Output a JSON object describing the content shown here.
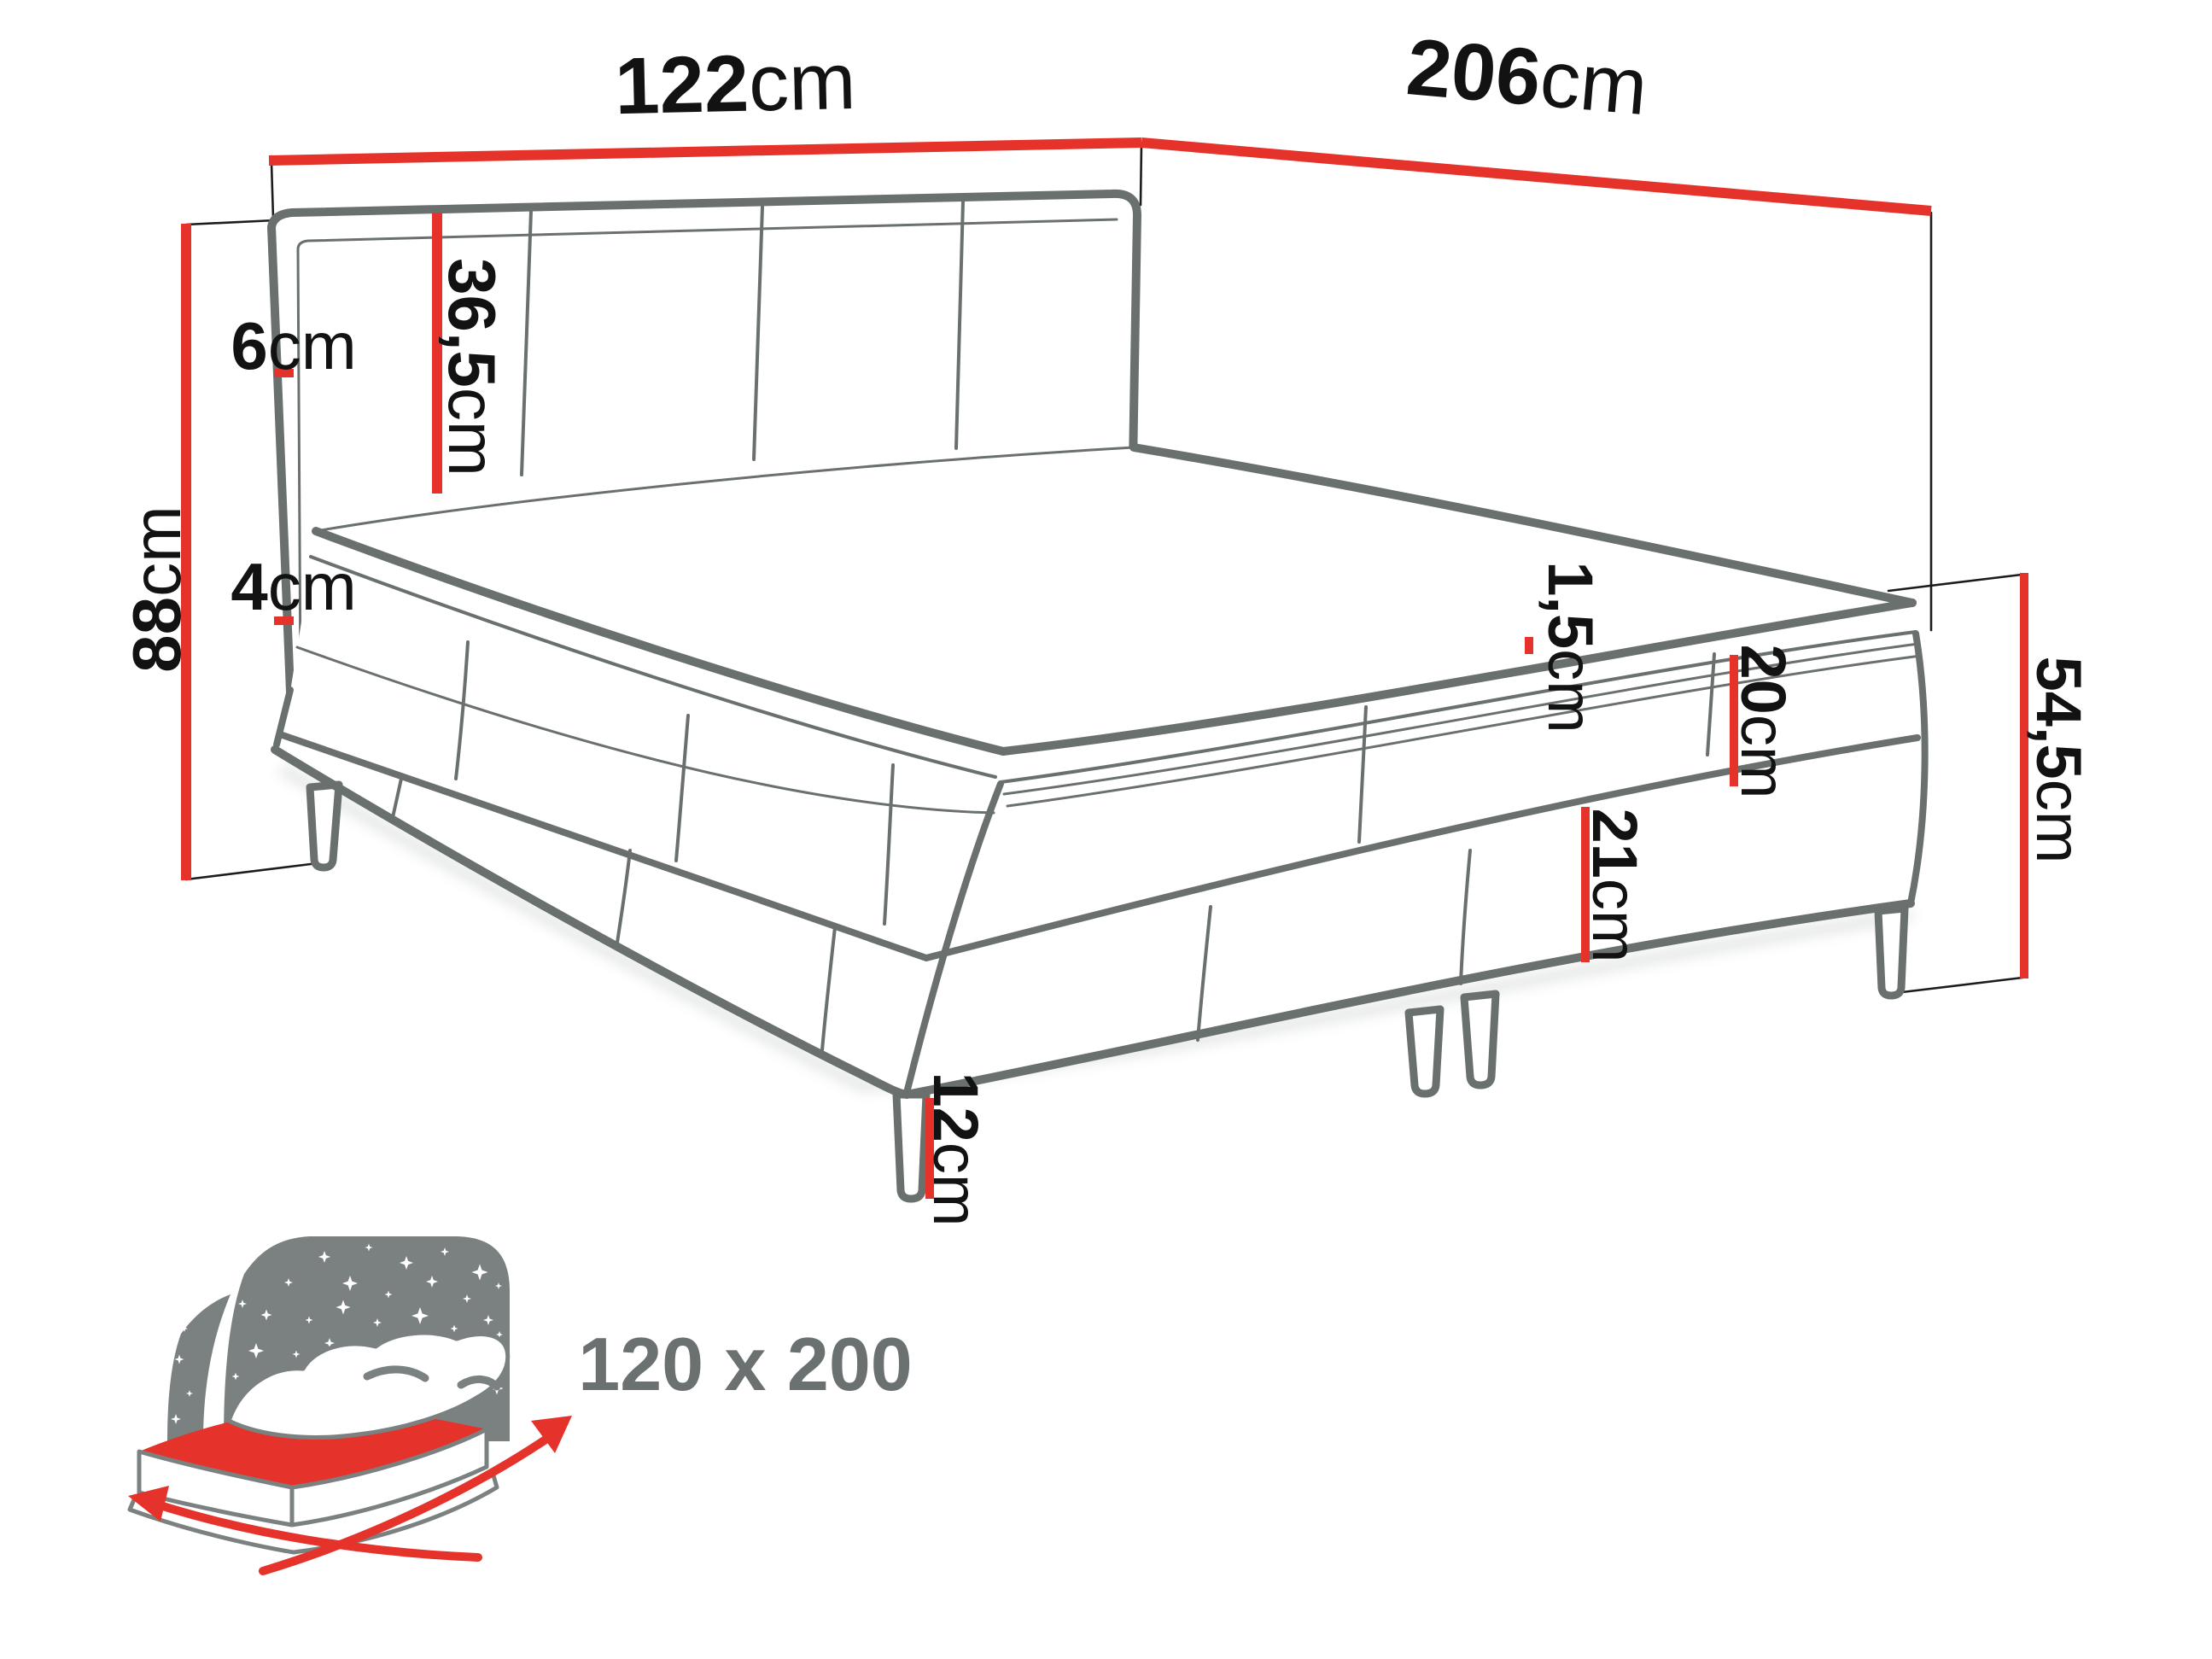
{
  "diagram_type": "bed-dimensions-technical-drawing",
  "colors": {
    "accent_red": "#e5332b",
    "outline_gray": "#6a706e",
    "icon_gray": "#7b8181",
    "label_black": "#121212",
    "size_label_gray": "#6b7070",
    "background": "#ffffff"
  },
  "dimensions": {
    "headboard_width": {
      "value": "122",
      "unit": "cm"
    },
    "total_length": {
      "value": "206",
      "unit": "cm"
    },
    "total_height": {
      "value": "88",
      "unit": "cm"
    },
    "headboard_thickness": {
      "value": "6",
      "unit": "cm"
    },
    "headboard_panel": {
      "value": "36,5",
      "unit": "cm"
    },
    "topper_thickness": {
      "value": "4",
      "unit": "cm"
    },
    "mattress_gap": {
      "value": "1,5",
      "unit": "cm"
    },
    "upper_box_height": {
      "value": "20",
      "unit": "cm"
    },
    "lower_box_height": {
      "value": "21",
      "unit": "cm"
    },
    "base_height": {
      "value": "54,5",
      "unit": "cm"
    },
    "leg_height": {
      "value": "12",
      "unit": "cm"
    }
  },
  "size_label": "120 x 200",
  "icons": {
    "bed_size_icon": "bed-with-starry-headboard-and-size-arrows"
  }
}
